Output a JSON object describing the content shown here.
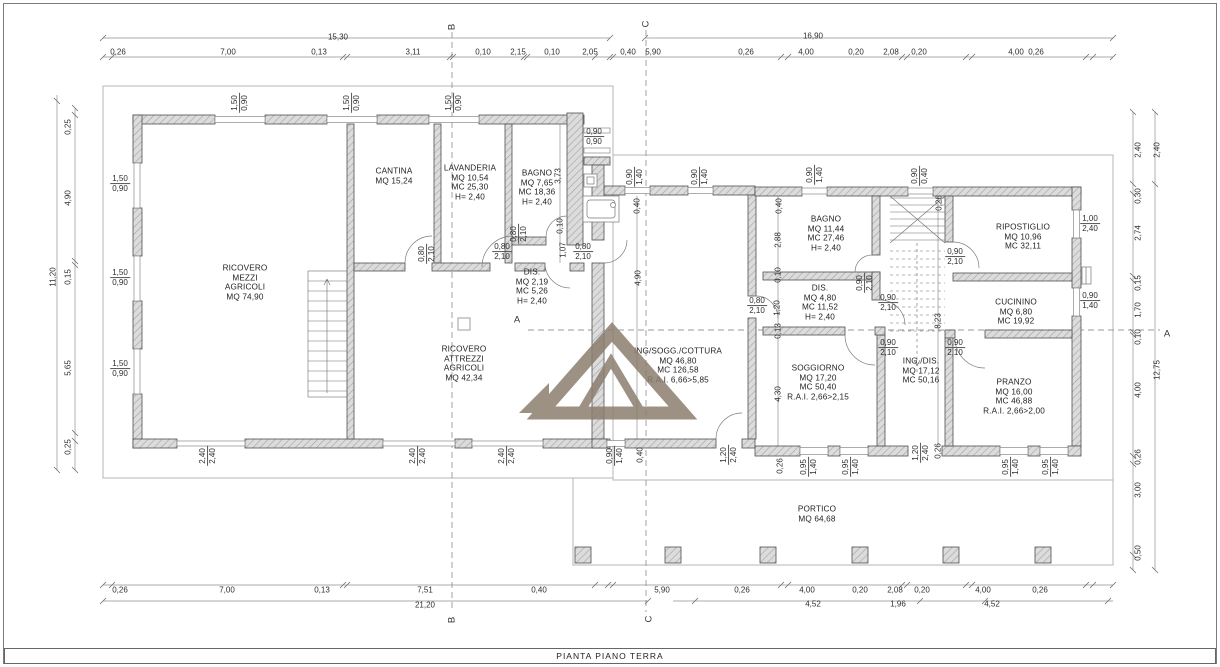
{
  "drawing_title": "PIANTA PIANO TERRA",
  "watermark": {
    "color": "#8c7e6f"
  },
  "labels": [
    {
      "n": "section-marker-b-top",
      "t": "marker",
      "x": 452,
      "y": 27,
      "rot": true,
      "lines": [
        "B"
      ]
    },
    {
      "n": "section-marker-b-bottom",
      "t": "marker",
      "x": 452,
      "y": 620,
      "rot": true,
      "lines": [
        "B"
      ]
    },
    {
      "n": "section-marker-c-top",
      "t": "marker",
      "x": 646,
      "y": 24,
      "rot": true,
      "lines": [
        "C"
      ]
    },
    {
      "n": "section-marker-c-bottom",
      "t": "marker",
      "x": 649,
      "y": 619,
      "rot": true,
      "lines": [
        "C"
      ]
    },
    {
      "n": "section-marker-a-left",
      "t": "marker",
      "x": 517,
      "y": 320,
      "lines": [
        "A"
      ]
    },
    {
      "n": "section-marker-a-right",
      "t": "marker",
      "x": 1167,
      "y": 334,
      "lines": [
        "A"
      ]
    },
    {
      "n": "dim-top-overall-left",
      "t": "dim",
      "x": 338,
      "y": 37,
      "lines": [
        "15,30"
      ]
    },
    {
      "n": "dim-top-overall-right",
      "t": "dim",
      "x": 813,
      "y": 36,
      "lines": [
        "16,90"
      ]
    },
    {
      "n": "dim-top",
      "t": "dim",
      "x": 118,
      "y": 52,
      "lines": [
        "0,26"
      ]
    },
    {
      "n": "dim-top",
      "t": "dim",
      "x": 228,
      "y": 52,
      "lines": [
        "7,00"
      ]
    },
    {
      "n": "dim-top",
      "t": "dim",
      "x": 319,
      "y": 52,
      "lines": [
        "0,13"
      ]
    },
    {
      "n": "dim-top",
      "t": "dim",
      "x": 413,
      "y": 52,
      "lines": [
        "3,11"
      ]
    },
    {
      "n": "dim-top",
      "t": "dim",
      "x": 483,
      "y": 52,
      "lines": [
        "0,10"
      ]
    },
    {
      "n": "dim-top",
      "t": "dim",
      "x": 518,
      "y": 52,
      "lines": [
        "2,15"
      ]
    },
    {
      "n": "dim-top",
      "t": "dim",
      "x": 552,
      "y": 52,
      "lines": [
        "0,10"
      ]
    },
    {
      "n": "dim-top",
      "t": "dim",
      "x": 590,
      "y": 52,
      "lines": [
        "2,05"
      ]
    },
    {
      "n": "dim-top",
      "t": "dim",
      "x": 628,
      "y": 52,
      "lines": [
        "0,40"
      ]
    },
    {
      "n": "dim-top",
      "t": "dim",
      "x": 653,
      "y": 52,
      "lines": [
        "5,90"
      ]
    },
    {
      "n": "dim-top",
      "t": "dim",
      "x": 746,
      "y": 52,
      "lines": [
        "0,26"
      ]
    },
    {
      "n": "dim-top",
      "t": "dim",
      "x": 806,
      "y": 52,
      "lines": [
        "4,00"
      ]
    },
    {
      "n": "dim-top",
      "t": "dim",
      "x": 856,
      "y": 52,
      "lines": [
        "0,20"
      ]
    },
    {
      "n": "dim-top",
      "t": "dim",
      "x": 891,
      "y": 52,
      "lines": [
        "2,08"
      ]
    },
    {
      "n": "dim-top",
      "t": "dim",
      "x": 919,
      "y": 52,
      "lines": [
        "0,20"
      ]
    },
    {
      "n": "dim-top",
      "t": "dim",
      "x": 1016,
      "y": 52,
      "lines": [
        "4,00"
      ]
    },
    {
      "n": "dim-top",
      "t": "dim",
      "x": 1036,
      "y": 52,
      "lines": [
        "0,26"
      ]
    },
    {
      "n": "dim-bottom",
      "t": "dim",
      "x": 120,
      "y": 590,
      "lines": [
        "0,26"
      ]
    },
    {
      "n": "dim-bottom",
      "t": "dim",
      "x": 227,
      "y": 590,
      "lines": [
        "7,00"
      ]
    },
    {
      "n": "dim-bottom",
      "t": "dim",
      "x": 322,
      "y": 590,
      "lines": [
        "0,13"
      ]
    },
    {
      "n": "dim-bottom",
      "t": "dim",
      "x": 425,
      "y": 590,
      "lines": [
        "7,51"
      ]
    },
    {
      "n": "dim-bottom",
      "t": "dim",
      "x": 539,
      "y": 590,
      "lines": [
        "0,40"
      ]
    },
    {
      "n": "dim-bottom",
      "t": "dim",
      "x": 662,
      "y": 590,
      "lines": [
        "5,90"
      ]
    },
    {
      "n": "dim-bottom",
      "t": "dim",
      "x": 742,
      "y": 590,
      "lines": [
        "0,26"
      ]
    },
    {
      "n": "dim-bottom",
      "t": "dim",
      "x": 807,
      "y": 590,
      "lines": [
        "4,00"
      ]
    },
    {
      "n": "dim-bottom",
      "t": "dim",
      "x": 860,
      "y": 590,
      "lines": [
        "0,20"
      ]
    },
    {
      "n": "dim-bottom",
      "t": "dim",
      "x": 895,
      "y": 590,
      "lines": [
        "2,08"
      ]
    },
    {
      "n": "dim-bottom",
      "t": "dim",
      "x": 922,
      "y": 590,
      "lines": [
        "0,20"
      ]
    },
    {
      "n": "dim-bottom",
      "t": "dim",
      "x": 983,
      "y": 590,
      "lines": [
        "4,00"
      ]
    },
    {
      "n": "dim-bottom",
      "t": "dim",
      "x": 1040,
      "y": 590,
      "lines": [
        "0,26"
      ]
    },
    {
      "n": "dim-bottom-overall",
      "t": "dim",
      "x": 425,
      "y": 605,
      "lines": [
        "21,20"
      ]
    },
    {
      "n": "dim-bottom",
      "t": "dim",
      "x": 813,
      "y": 604,
      "lines": [
        "4,52"
      ]
    },
    {
      "n": "dim-bottom",
      "t": "dim",
      "x": 898,
      "y": 604,
      "lines": [
        "1,96"
      ]
    },
    {
      "n": "dim-bottom",
      "t": "dim",
      "x": 992,
      "y": 604,
      "lines": [
        "4,52"
      ]
    },
    {
      "n": "dim-left-overall",
      "t": "dim",
      "x": 53,
      "y": 277,
      "rot": true,
      "lines": [
        "11,20"
      ]
    },
    {
      "n": "dim-left",
      "t": "dim",
      "x": 68,
      "y": 127,
      "rot": true,
      "lines": [
        "0,25"
      ]
    },
    {
      "n": "dim-left",
      "t": "dim",
      "x": 68,
      "y": 198,
      "rot": true,
      "lines": [
        "4,90"
      ]
    },
    {
      "n": "dim-left",
      "t": "dim",
      "x": 68,
      "y": 277,
      "rot": true,
      "lines": [
        "0,15"
      ]
    },
    {
      "n": "dim-left",
      "t": "dim",
      "x": 68,
      "y": 368,
      "rot": true,
      "lines": [
        "5,65"
      ]
    },
    {
      "n": "dim-left",
      "t": "dim",
      "x": 68,
      "y": 447,
      "rot": true,
      "lines": [
        "0,25"
      ]
    },
    {
      "n": "dim-right",
      "t": "dim",
      "x": 1138,
      "y": 150,
      "rot": true,
      "lines": [
        "2,40"
      ]
    },
    {
      "n": "dim-right",
      "t": "dim",
      "x": 1138,
      "y": 196,
      "rot": true,
      "lines": [
        "0,30"
      ]
    },
    {
      "n": "dim-right",
      "t": "dim",
      "x": 1138,
      "y": 233,
      "rot": true,
      "lines": [
        "2,74"
      ]
    },
    {
      "n": "dim-right",
      "t": "dim",
      "x": 1138,
      "y": 283,
      "rot": true,
      "lines": [
        "0,15"
      ]
    },
    {
      "n": "dim-right",
      "t": "dim",
      "x": 1138,
      "y": 310,
      "rot": true,
      "lines": [
        "1,70"
      ]
    },
    {
      "n": "dim-right",
      "t": "dim",
      "x": 1138,
      "y": 337,
      "rot": true,
      "lines": [
        "0,10"
      ]
    },
    {
      "n": "dim-right",
      "t": "dim",
      "x": 1138,
      "y": 390,
      "rot": true,
      "lines": [
        "4,00"
      ]
    },
    {
      "n": "dim-right",
      "t": "dim",
      "x": 1138,
      "y": 457,
      "rot": true,
      "lines": [
        "0,26"
      ]
    },
    {
      "n": "dim-right",
      "t": "dim",
      "x": 1138,
      "y": 490,
      "rot": true,
      "lines": [
        "3,00"
      ]
    },
    {
      "n": "dim-right",
      "t": "dim",
      "x": 1138,
      "y": 553,
      "rot": true,
      "lines": [
        "0,50"
      ]
    },
    {
      "n": "dim-right-overall",
      "t": "dim",
      "x": 1157,
      "y": 150,
      "rot": true,
      "lines": [
        "2,40"
      ]
    },
    {
      "n": "dim-right-overall",
      "t": "dim",
      "x": 1157,
      "y": 370,
      "rot": true,
      "lines": [
        "12,75"
      ]
    },
    {
      "n": "dim-window",
      "t": "dim",
      "x": 240,
      "y": 103,
      "rot": true,
      "lines": [
        "1,50",
        "0,90"
      ]
    },
    {
      "n": "dim-window",
      "t": "dim",
      "x": 352,
      "y": 103,
      "rot": true,
      "lines": [
        "1,50",
        "0,90"
      ]
    },
    {
      "n": "dim-window",
      "t": "dim",
      "x": 454,
      "y": 103,
      "rot": true,
      "lines": [
        "1,50",
        "0,90"
      ]
    },
    {
      "n": "dim-window",
      "t": "dim",
      "x": 120,
      "y": 184,
      "lines": [
        "1,50",
        "0,90"
      ]
    },
    {
      "n": "dim-window",
      "t": "dim",
      "x": 120,
      "y": 278,
      "lines": [
        "1,50",
        "0,90"
      ]
    },
    {
      "n": "dim-window",
      "t": "dim",
      "x": 120,
      "y": 369,
      "lines": [
        "1,50",
        "0,90"
      ]
    },
    {
      "n": "dim-window",
      "t": "dim",
      "x": 594,
      "y": 137,
      "lines": [
        "0,90",
        "0,90"
      ]
    },
    {
      "n": "dim-wall",
      "t": "dim",
      "x": 558,
      "y": 176,
      "rot": true,
      "lines": [
        "3,73"
      ]
    },
    {
      "n": "dim-wall",
      "t": "dim",
      "x": 560,
      "y": 226,
      "rot": true,
      "lines": [
        "0,10"
      ]
    },
    {
      "n": "dim-door",
      "t": "dim",
      "x": 519,
      "y": 234,
      "rot": true,
      "lines": [
        "0,80",
        "2,10"
      ]
    },
    {
      "n": "dim-wall",
      "t": "dim",
      "x": 563,
      "y": 250,
      "rot": true,
      "lines": [
        "1,07"
      ]
    },
    {
      "n": "dim-door",
      "t": "dim",
      "x": 502,
      "y": 252,
      "lines": [
        "0,80",
        "2,10"
      ]
    },
    {
      "n": "dim-door",
      "t": "dim",
      "x": 583,
      "y": 252,
      "lines": [
        "0,80",
        "2,10"
      ]
    },
    {
      "n": "dim-door",
      "t": "dim",
      "x": 427,
      "y": 254,
      "rot": true,
      "lines": [
        "0,80",
        "2,10"
      ]
    },
    {
      "n": "dim-window",
      "t": "dim",
      "x": 635,
      "y": 177,
      "rot": true,
      "lines": [
        "0,90",
        "1,40"
      ]
    },
    {
      "n": "dim-window",
      "t": "dim",
      "x": 700,
      "y": 177,
      "rot": true,
      "lines": [
        "0,90",
        "1,40"
      ]
    },
    {
      "n": "dim-wall",
      "t": "dim",
      "x": 637,
      "y": 206,
      "rot": true,
      "lines": [
        "0,40"
      ]
    },
    {
      "n": "dim-wall",
      "t": "dim",
      "x": 638,
      "y": 278,
      "rot": true,
      "lines": [
        "4,90"
      ]
    },
    {
      "n": "dim-window",
      "t": "dim",
      "x": 815,
      "y": 175,
      "rot": true,
      "lines": [
        "0,90",
        "1,40"
      ]
    },
    {
      "n": "dim-window",
      "t": "dim",
      "x": 920,
      "y": 176,
      "rot": true,
      "lines": [
        "0,90",
        "0,40"
      ]
    },
    {
      "n": "dim-wall",
      "t": "dim",
      "x": 939,
      "y": 203,
      "rot": true,
      "lines": [
        "0,26"
      ]
    },
    {
      "n": "dim-wall",
      "t": "dim",
      "x": 779,
      "y": 206,
      "rot": true,
      "lines": [
        "0,40"
      ]
    },
    {
      "n": "dim-wall",
      "t": "dim",
      "x": 778,
      "y": 240,
      "rot": true,
      "lines": [
        "2,88"
      ]
    },
    {
      "n": "dim-wall",
      "t": "dim",
      "x": 778,
      "y": 275,
      "rot": true,
      "lines": [
        "0,10"
      ]
    },
    {
      "n": "dim-wall",
      "t": "dim",
      "x": 777,
      "y": 308,
      "rot": true,
      "lines": [
        "1,20"
      ]
    },
    {
      "n": "dim-door",
      "t": "dim",
      "x": 757,
      "y": 306,
      "lines": [
        "0,80",
        "2,10"
      ]
    },
    {
      "n": "dim-wall",
      "t": "dim",
      "x": 778,
      "y": 331,
      "rot": true,
      "lines": [
        "0,13"
      ]
    },
    {
      "n": "dim-wall",
      "t": "dim",
      "x": 778,
      "y": 394,
      "rot": true,
      "lines": [
        "4,30"
      ]
    },
    {
      "n": "dim-wall",
      "t": "dim",
      "x": 938,
      "y": 321,
      "rot": true,
      "lines": [
        "8,23"
      ]
    },
    {
      "n": "dim-door",
      "t": "dim",
      "x": 865,
      "y": 283,
      "rot": true,
      "lines": [
        "0,90",
        "2,10"
      ]
    },
    {
      "n": "dim-door",
      "t": "dim",
      "x": 888,
      "y": 303,
      "lines": [
        "0,90",
        "2,10"
      ]
    },
    {
      "n": "dim-door",
      "t": "dim",
      "x": 955,
      "y": 257,
      "lines": [
        "0,90",
        "2,10"
      ]
    },
    {
      "n": "dim-door",
      "t": "dim",
      "x": 888,
      "y": 348,
      "lines": [
        "0,90",
        "2,10"
      ]
    },
    {
      "n": "dim-door",
      "t": "dim",
      "x": 955,
      "y": 348,
      "lines": [
        "0,90",
        "2,10"
      ]
    },
    {
      "n": "dim-window",
      "t": "dim",
      "x": 1090,
      "y": 224,
      "lines": [
        "1,00",
        "2,40"
      ]
    },
    {
      "n": "dim-window",
      "t": "dim",
      "x": 1090,
      "y": 301,
      "lines": [
        "0,90",
        "1,40"
      ]
    },
    {
      "n": "dim-window",
      "t": "dim",
      "x": 615,
      "y": 456,
      "rot": true,
      "lines": [
        "0,90",
        "1,40"
      ]
    },
    {
      "n": "dim-wall",
      "t": "dim",
      "x": 640,
      "y": 455,
      "rot": true,
      "lines": [
        "0,40"
      ]
    },
    {
      "n": "dim-door",
      "t": "dim",
      "x": 729,
      "y": 455,
      "rot": true,
      "lines": [
        "1,20",
        "2,40"
      ]
    },
    {
      "n": "dim-wall",
      "t": "dim",
      "x": 780,
      "y": 466,
      "rot": true,
      "lines": [
        "0,26"
      ]
    },
    {
      "n": "dim-window",
      "t": "dim",
      "x": 809,
      "y": 467,
      "rot": true,
      "lines": [
        "0,95",
        "1,40"
      ]
    },
    {
      "n": "dim-window",
      "t": "dim",
      "x": 851,
      "y": 467,
      "rot": true,
      "lines": [
        "0,95",
        "1,40"
      ]
    },
    {
      "n": "dim-door",
      "t": "dim",
      "x": 921,
      "y": 453,
      "rot": true,
      "lines": [
        "1,20",
        "2,40"
      ]
    },
    {
      "n": "dim-wall",
      "t": "dim",
      "x": 938,
      "y": 451,
      "rot": true,
      "lines": [
        "0,26"
      ]
    },
    {
      "n": "dim-window",
      "t": "dim",
      "x": 1011,
      "y": 467,
      "rot": true,
      "lines": [
        "0,95",
        "1,40"
      ]
    },
    {
      "n": "dim-window",
      "t": "dim",
      "x": 1051,
      "y": 467,
      "rot": true,
      "lines": [
        "0,95",
        "1,40"
      ]
    },
    {
      "n": "dim-door",
      "t": "dim",
      "x": 208,
      "y": 456,
      "rot": true,
      "lines": [
        "2,40",
        "2,40"
      ]
    },
    {
      "n": "dim-door",
      "t": "dim",
      "x": 418,
      "y": 456,
      "rot": true,
      "lines": [
        "2,40",
        "2,40"
      ]
    },
    {
      "n": "dim-door",
      "t": "dim",
      "x": 507,
      "y": 456,
      "rot": true,
      "lines": [
        "2,40",
        "2,40"
      ]
    },
    {
      "n": "room-ricovero-mezzi",
      "t": "room",
      "x": 245,
      "y": 283,
      "lines": [
        "RICOVERO",
        "MEZZI",
        "AGRICOLI",
        "MQ  74,90"
      ]
    },
    {
      "n": "room-cantina",
      "t": "room",
      "x": 394,
      "y": 176,
      "lines": [
        "CANTINA",
        "MQ  15,24"
      ]
    },
    {
      "n": "room-lavanderia",
      "t": "room",
      "x": 470,
      "y": 183,
      "lines": [
        "LAVANDERIA",
        "MQ  10,54",
        "MC 25,30",
        "H= 2,40"
      ]
    },
    {
      "n": "room-bagno-1",
      "t": "room",
      "x": 537,
      "y": 188,
      "lines": [
        "BAGNO",
        "MQ  7,65",
        "MC 18,36",
        "H= 2,40"
      ]
    },
    {
      "n": "room-dis-1",
      "t": "room",
      "x": 532,
      "y": 287,
      "lines": [
        "DIS.",
        "MQ 2,19",
        "MC 5,26",
        "H= 2,40"
      ]
    },
    {
      "n": "room-ricovero-attrezzi",
      "t": "room",
      "x": 464,
      "y": 364,
      "lines": [
        "RICOVERO",
        "ATTREZZI",
        "AGRICOLI",
        "MQ  42,34"
      ]
    },
    {
      "n": "room-ing-sogg-cottura",
      "t": "room",
      "x": 678,
      "y": 366,
      "lines": [
        "ING/SOGG./COTTURA",
        "MQ  46,80",
        "MC 126,58",
        "R.A.I. 6,66>5,85"
      ]
    },
    {
      "n": "room-bagno-2",
      "t": "room",
      "x": 826,
      "y": 234,
      "lines": [
        "BAGNO",
        "MQ  11,44",
        "MC 27,46",
        "H= 2,40"
      ]
    },
    {
      "n": "room-dis-2",
      "t": "room",
      "x": 820,
      "y": 303,
      "lines": [
        "DIS.",
        "MQ  4,80",
        "MC 11,52",
        "H= 2,40"
      ]
    },
    {
      "n": "room-ripostiglio",
      "t": "room",
      "x": 1023,
      "y": 237,
      "lines": [
        "RIPOSTIGLIO",
        "MQ 10,96",
        "MC 32,11"
      ]
    },
    {
      "n": "room-cucinino",
      "t": "room",
      "x": 1016,
      "y": 312,
      "lines": [
        "CUCININO",
        "MQ  6,80",
        "MC 19,92"
      ]
    },
    {
      "n": "room-soggiorno",
      "t": "room",
      "x": 818,
      "y": 383,
      "lines": [
        "SOGGIORNO",
        "MQ  17,20",
        "MC 50,40",
        "R.A.I. 2,66>2,15"
      ]
    },
    {
      "n": "room-ing-dis",
      "t": "room",
      "x": 921,
      "y": 371,
      "lines": [
        "ING./DIS.",
        "MQ  17,12",
        "MC  50,16"
      ]
    },
    {
      "n": "room-pranzo",
      "t": "room",
      "x": 1014,
      "y": 397,
      "lines": [
        "PRANZO",
        "MQ  16,00",
        "MC  46,88",
        "R.A.I. 2,66>2,00"
      ]
    },
    {
      "n": "room-portico",
      "t": "room",
      "x": 817,
      "y": 514,
      "lines": [
        "PORTICO",
        "MQ  64,68"
      ]
    }
  ]
}
